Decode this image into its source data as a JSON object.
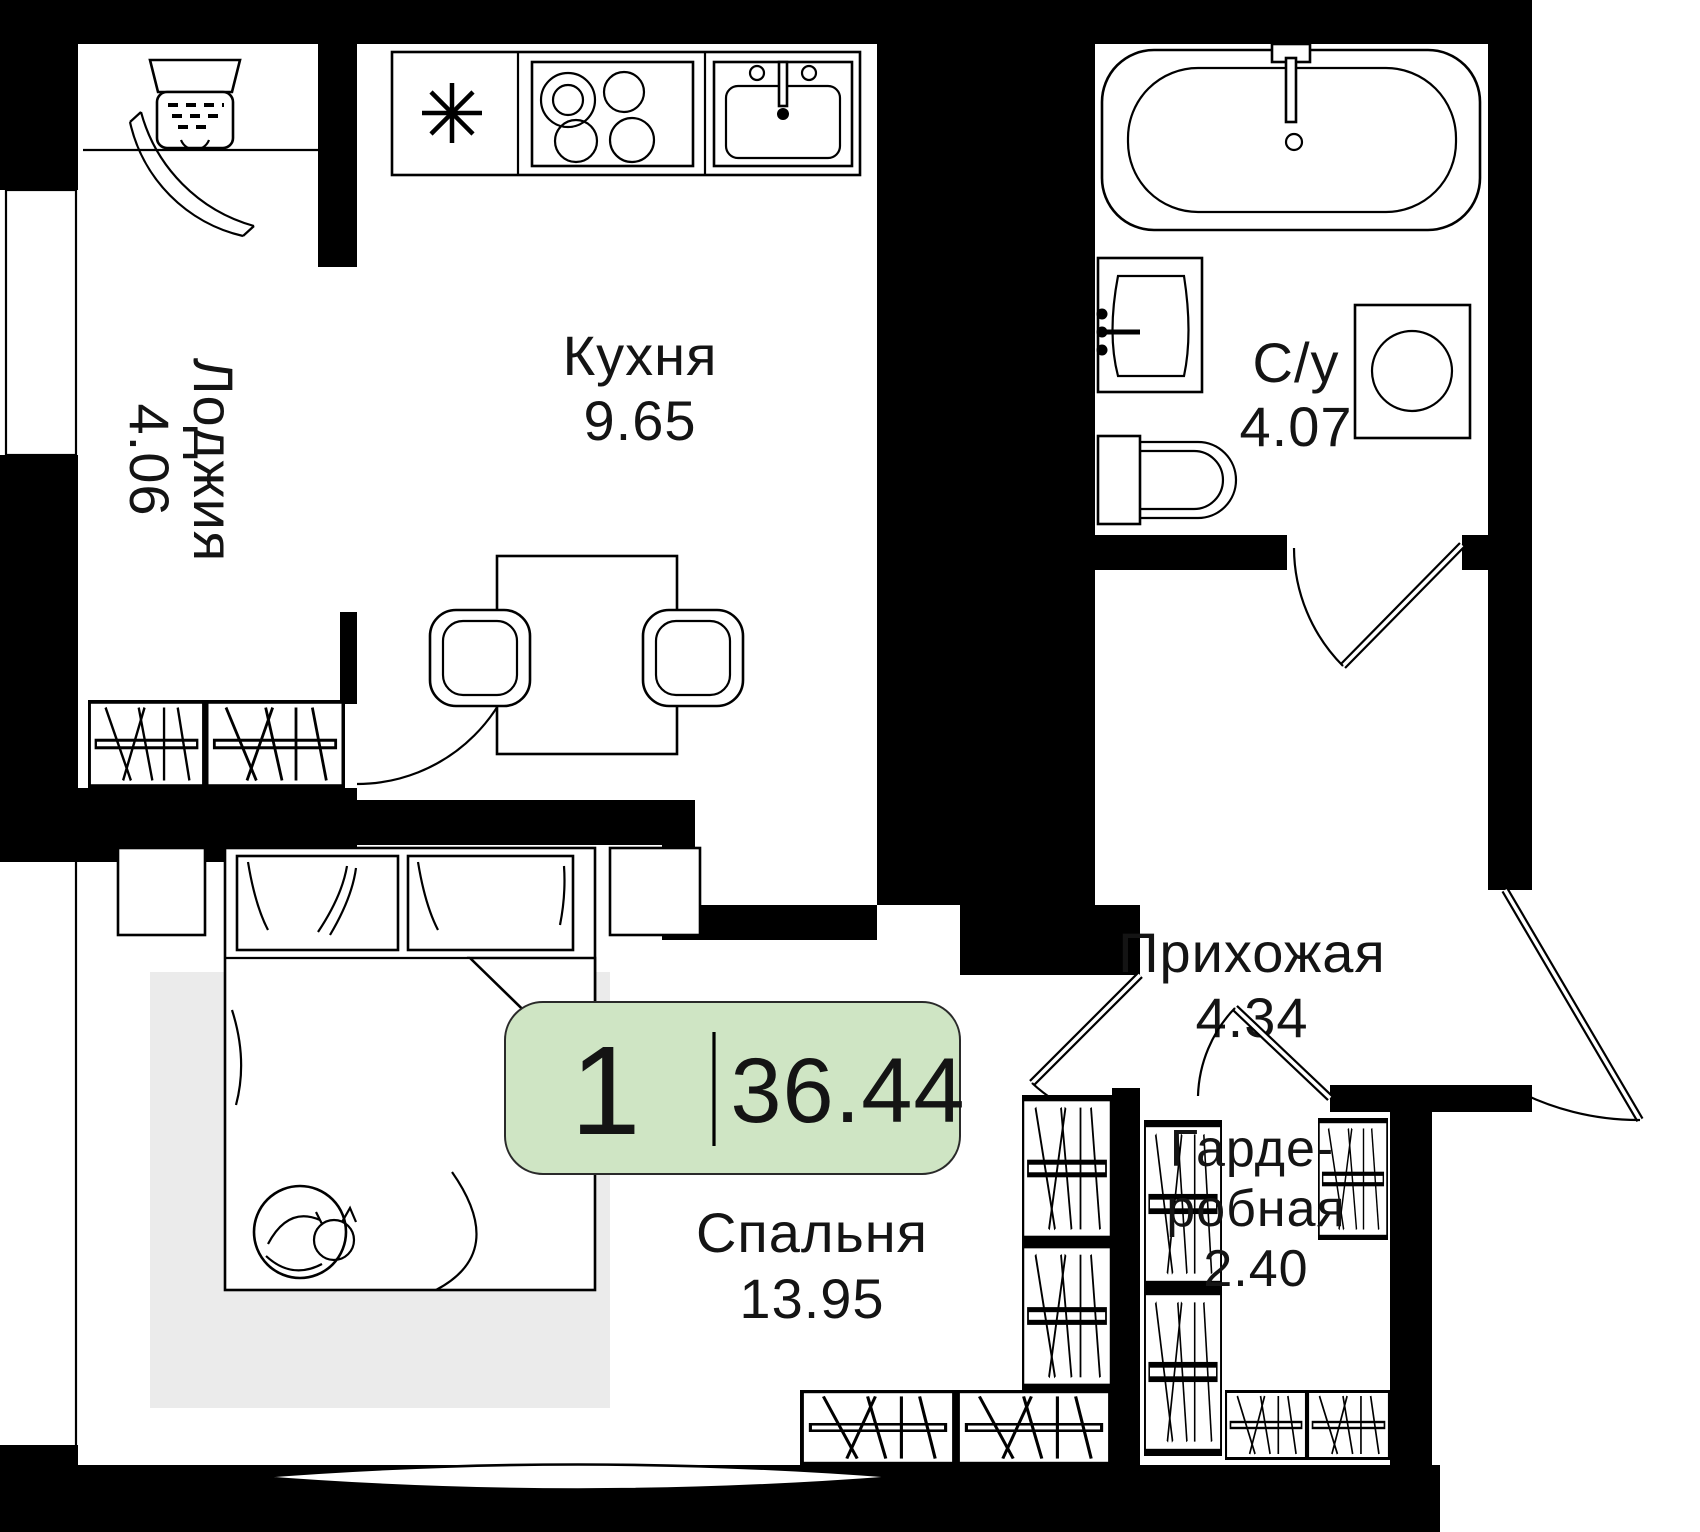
{
  "plan": {
    "badge": {
      "rooms_count": "1",
      "total_area": "36.44",
      "bg_color": "#cfe5c4"
    },
    "rooms": {
      "loggia": {
        "name": "Лоджия",
        "area": "4.06"
      },
      "kitchen": {
        "name": "Кухня",
        "area": "9.65"
      },
      "bathroom": {
        "name": "С/у",
        "area": "4.07"
      },
      "hallway": {
        "name": "Прихожая",
        "area": "4.34"
      },
      "bedroom": {
        "name": "Спальня",
        "area": "13.95"
      },
      "wardrobe": {
        "name_lines": [
          "Гарде-",
          "робная"
        ],
        "area": "2.40"
      }
    },
    "colors": {
      "wall": "#000000",
      "rug": "#ebebeb",
      "badge": "#cfe5c4"
    },
    "icons": [
      "washer-dryer",
      "balcony-door-arc",
      "asterisk",
      "stove",
      "kitchen-sink",
      "dining-table",
      "chair",
      "ventilation-shaft",
      "bathtub",
      "washbasin",
      "toilet",
      "washing-machine",
      "bed",
      "pillow",
      "cat",
      "rug",
      "nightstand",
      "closet",
      "window",
      "door-leaf",
      "door-arc"
    ]
  }
}
